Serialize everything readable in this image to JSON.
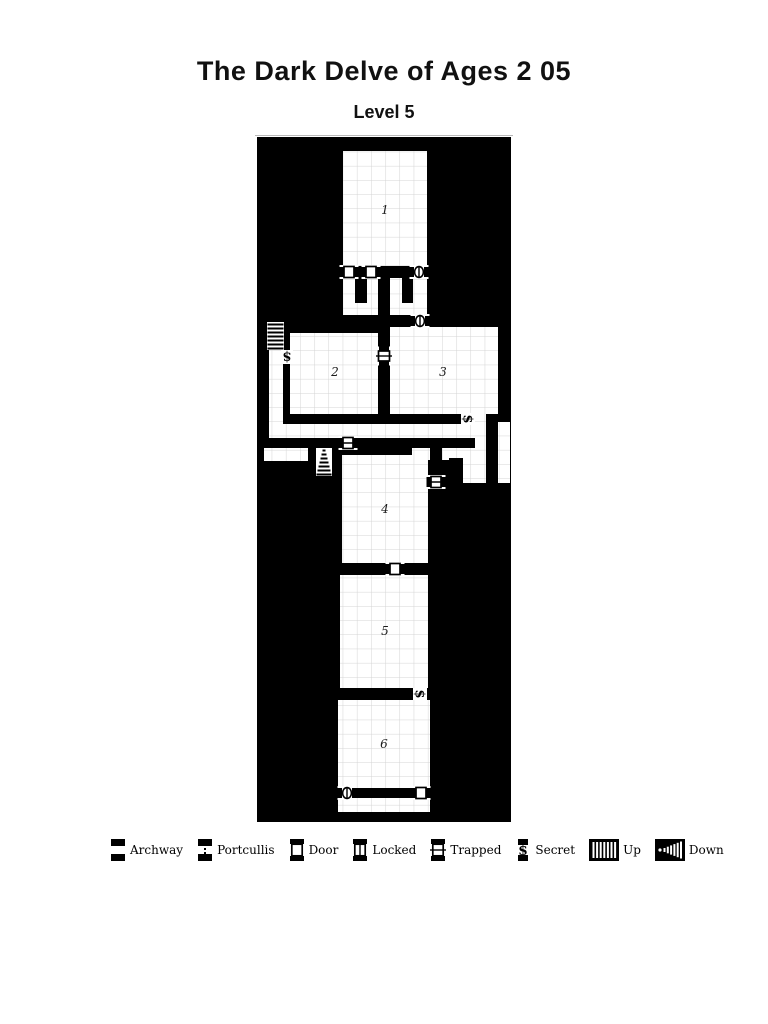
{
  "title": "The Dark Delve of Ages 2 05",
  "subtitle": "Level 5",
  "colors": {
    "map_bg": "#000000",
    "floor": "#ffffff",
    "grid": "#d4d4d4",
    "room_number": "#1c1c1c"
  },
  "map": {
    "x": 257,
    "y": 137,
    "w": 254,
    "h": 685,
    "grid_size": 14.2,
    "floors": [
      [
        343,
        151,
        84,
        115
      ],
      [
        343,
        266,
        84,
        61
      ],
      [
        269,
        323,
        14,
        115
      ],
      [
        290,
        333,
        88,
        81
      ],
      [
        390,
        327,
        108,
        87
      ],
      [
        269,
        424,
        217,
        14
      ],
      [
        264,
        448,
        77,
        13
      ],
      [
        317,
        448,
        14,
        28
      ],
      [
        475,
        408,
        11,
        40
      ],
      [
        412,
        448,
        74,
        12
      ],
      [
        498,
        422,
        12,
        61
      ],
      [
        463,
        460,
        23,
        23
      ],
      [
        342,
        455,
        86,
        108
      ],
      [
        388,
        563,
        14,
        12
      ],
      [
        340,
        575,
        88,
        113
      ],
      [
        413,
        688,
        14,
        12
      ],
      [
        338,
        700,
        92,
        112
      ]
    ],
    "walls": [
      [
        357,
        266,
        6,
        12
      ],
      [
        379,
        266,
        32,
        12
      ],
      [
        355,
        278,
        12,
        25
      ],
      [
        378,
        278,
        12,
        70
      ],
      [
        402,
        278,
        11,
        25
      ],
      [
        343,
        315,
        35,
        12
      ],
      [
        390,
        315,
        21,
        12
      ],
      [
        378,
        364,
        12,
        50
      ],
      [
        283,
        414,
        178,
        10
      ],
      [
        356,
        438,
        119,
        10
      ],
      [
        308,
        448,
        9,
        28
      ],
      [
        331,
        448,
        10,
        28
      ],
      [
        430,
        448,
        12,
        28
      ],
      [
        449,
        458,
        14,
        52
      ],
      [
        352,
        788,
        63,
        10
      ]
    ],
    "rooms": [
      {
        "number": "1",
        "cx": 385,
        "cy": 210
      },
      {
        "number": "2",
        "cx": 335,
        "cy": 372
      },
      {
        "number": "3",
        "cx": 443,
        "cy": 372
      },
      {
        "number": "4",
        "cx": 385,
        "cy": 509
      },
      {
        "number": "5",
        "cx": 385,
        "cy": 631
      },
      {
        "number": "6",
        "cx": 384,
        "cy": 744
      }
    ],
    "doors": [
      {
        "type": "door",
        "x": 349,
        "y": 272,
        "o": "h"
      },
      {
        "type": "door",
        "x": 371,
        "y": 272,
        "o": "h"
      },
      {
        "type": "portcullis",
        "x": 419,
        "y": 272,
        "o": "h"
      },
      {
        "type": "portcullis",
        "x": 420,
        "y": 321,
        "o": "h"
      },
      {
        "type": "trapped",
        "x": 384,
        "y": 356,
        "o": "v"
      },
      {
        "type": "secret",
        "x": 287,
        "y": 357,
        "o": "v"
      },
      {
        "type": "secret",
        "x": 468,
        "y": 419,
        "o": "h"
      },
      {
        "type": "locked",
        "x": 348,
        "y": 443,
        "o": "h"
      },
      {
        "type": "locked",
        "x": 436,
        "y": 482,
        "o": "h"
      },
      {
        "type": "door",
        "x": 395,
        "y": 569,
        "o": "h"
      },
      {
        "type": "secret",
        "x": 420,
        "y": 694,
        "o": "h"
      },
      {
        "type": "portcullis",
        "x": 347,
        "y": 793,
        "o": "h"
      },
      {
        "type": "door",
        "x": 421,
        "y": 793,
        "o": "h"
      }
    ],
    "stairs": [
      {
        "dir": "up",
        "x": 267,
        "y": 322,
        "w": 17,
        "h": 28
      },
      {
        "dir": "down",
        "x": 316,
        "y": 448,
        "w": 16,
        "h": 28
      }
    ]
  },
  "legend": {
    "items": [
      {
        "type": "archway",
        "label": "Archway"
      },
      {
        "type": "portcullis",
        "label": "Portcullis"
      },
      {
        "type": "door",
        "label": "Door"
      },
      {
        "type": "locked",
        "label": "Locked"
      },
      {
        "type": "trapped",
        "label": "Trapped"
      },
      {
        "type": "secret",
        "label": "Secret"
      },
      {
        "type": "up",
        "label": "Up"
      },
      {
        "type": "down",
        "label": "Down"
      }
    ]
  }
}
